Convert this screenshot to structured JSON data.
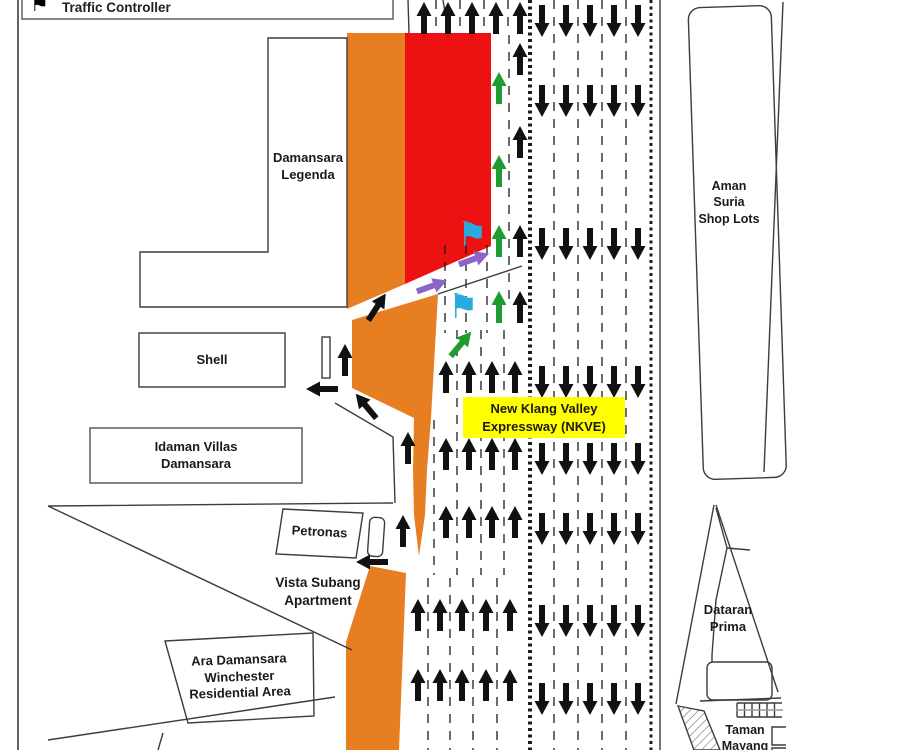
{
  "legend": {
    "traffic_controller": {
      "icon": "blue-flag",
      "label": "Traffic Controller"
    }
  },
  "areas": {
    "damansara_legenda": {
      "line1": "Damansara",
      "line2": "Legenda"
    },
    "shell": {
      "line1": "Shell"
    },
    "idaman_villas": {
      "line1": "Idaman Villas",
      "line2": "Damansara"
    },
    "petronas": {
      "line1": "Petronas"
    },
    "vista_subang": {
      "line1": "Vista Subang",
      "line2": "Apartment"
    },
    "ara_damansara": {
      "line1": "Ara Damansara",
      "line2": "Winchester",
      "line3": "Residential Area"
    },
    "aman_suria": {
      "line1": "Aman",
      "line2": "Suria",
      "line3": "Shop Lots"
    },
    "dataran_prima": {
      "line1": "Dataran",
      "line2": "Prima"
    },
    "taman_mayang": {
      "line1": "Taman",
      "line2": "Mayang"
    }
  },
  "highway_label": {
    "line1": "New Klang Valley",
    "line2": "Expressway (NKVE)"
  },
  "colors": {
    "closure_orange": "#E87E22",
    "closure_red": "#EE1111",
    "label_yellow": "#FFFF00",
    "arrow_black": "#111111",
    "arrow_green": "#1E9B31",
    "arrow_purple": "#8C64C8",
    "flag_blue": "#29ABE2"
  },
  "arrow_groups": [
    {
      "name": "southbound-lane-arrow",
      "color": "arrow_black",
      "angle": 180,
      "columns": [
        542,
        566,
        590,
        614,
        638
      ],
      "rows": [
        21,
        101,
        244,
        382,
        459,
        529,
        621,
        699
      ]
    },
    {
      "name": "northbound-top-lane-arrow",
      "color": "arrow_black",
      "angle": 0,
      "columns": [
        424,
        448,
        472,
        496,
        520
      ],
      "rows": [
        18
      ]
    },
    {
      "name": "contraflow-green-arrow",
      "color": "arrow_green",
      "angle": 0,
      "columns": [
        499
      ],
      "rows": [
        88,
        171,
        241,
        307
      ]
    },
    {
      "name": "northbound-open-lane-arrow",
      "color": "arrow_black",
      "angle": 0,
      "columns": [
        520
      ],
      "rows": [
        59,
        142,
        241,
        307
      ]
    },
    {
      "name": "northbound-lane-arrow-mid",
      "color": "arrow_black",
      "angle": 0,
      "columns": [
        446,
        469,
        492,
        515
      ],
      "rows": [
        377,
        454,
        522
      ]
    },
    {
      "name": "northbound-lane-arrow-bottom",
      "color": "arrow_black",
      "angle": 0,
      "columns": [
        418,
        440,
        462,
        486,
        510
      ],
      "rows": [
        615,
        685
      ]
    }
  ],
  "single_arrows": [
    {
      "name": "exit-arrow-up",
      "x": 345,
      "y": 360,
      "angle": 0,
      "color": "arrow_black"
    },
    {
      "name": "exit-arrow-left",
      "x": 322,
      "y": 389,
      "angle": -90,
      "color": "arrow_black"
    },
    {
      "name": "merge-arrow-up-right",
      "x": 377,
      "y": 307,
      "angle": 33,
      "color": "arrow_black"
    },
    {
      "name": "exit-arrow-up-left",
      "x": 366,
      "y": 406,
      "angle": -40,
      "color": "arrow_black"
    },
    {
      "name": "ramp-arrow-up-1",
      "x": 408,
      "y": 448,
      "angle": 0,
      "color": "arrow_black"
    },
    {
      "name": "ramp-arrow-up-2",
      "x": 403,
      "y": 531,
      "angle": 0,
      "color": "arrow_black"
    },
    {
      "name": "exit-arrow-left-2",
      "x": 372,
      "y": 562,
      "angle": -90,
      "color": "arrow_black"
    },
    {
      "name": "diversion-arrow-green",
      "x": 461,
      "y": 344,
      "angle": 40,
      "color": "arrow_green"
    },
    {
      "name": "diversion-arrow-purple-1",
      "x": 432,
      "y": 286,
      "angle": 70,
      "color": "arrow_purple"
    },
    {
      "name": "diversion-arrow-purple-2",
      "x": 474,
      "y": 259,
      "angle": 70,
      "color": "arrow_purple"
    }
  ],
  "flags": [
    {
      "name": "traffic-controller-flag-1",
      "x": 474,
      "y": 237
    },
    {
      "name": "traffic-controller-flag-2",
      "x": 465,
      "y": 309
    }
  ]
}
